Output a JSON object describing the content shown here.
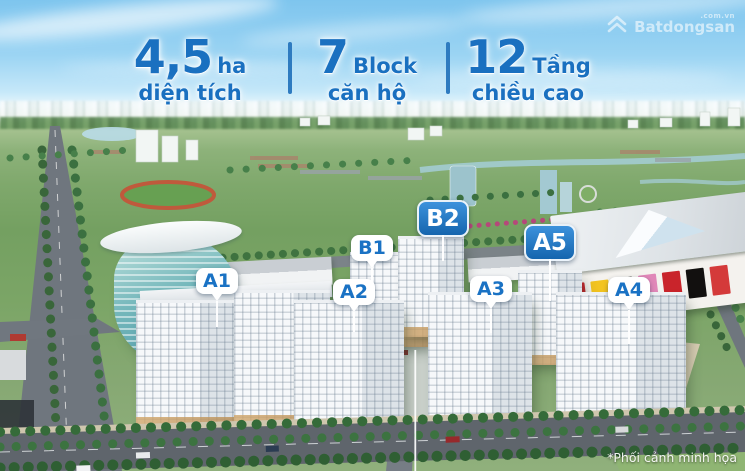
{
  "meta": {
    "caption": "*Phối cảnh minh họa",
    "watermark": {
      "name": "Batdongsan",
      "suffix": ".com.vn"
    }
  },
  "stats": {
    "items": [
      {
        "value": "4,5",
        "unit": "ha",
        "label": "diện tích"
      },
      {
        "value": "7",
        "unit": "Block",
        "label": "căn hộ"
      },
      {
        "value": "12",
        "unit": "Tầng",
        "label": "chiều cao"
      }
    ]
  },
  "buildings": {
    "labels": [
      {
        "id": "A1",
        "text": "A1",
        "style": "light"
      },
      {
        "id": "A2",
        "text": "A2",
        "style": "light"
      },
      {
        "id": "A3",
        "text": "A3",
        "style": "light"
      },
      {
        "id": "A4",
        "text": "A4",
        "style": "light"
      },
      {
        "id": "A5",
        "text": "A5",
        "style": "dark"
      },
      {
        "id": "B1",
        "text": "B1",
        "style": "light"
      },
      {
        "id": "B2",
        "text": "B2",
        "style": "dark"
      }
    ]
  },
  "colors": {
    "stat_accent": "#1a70c0",
    "bubble_highlight": "#1b6fc1",
    "bubble_text_light": "#1a72c4",
    "sky_top": "#7ec5ee",
    "mall_billboards": [
      "#c9242b",
      "#f3c420",
      "#1c1c1c",
      "#e087b8",
      "#c9242b",
      "#12100f",
      "#d43a3a"
    ]
  }
}
